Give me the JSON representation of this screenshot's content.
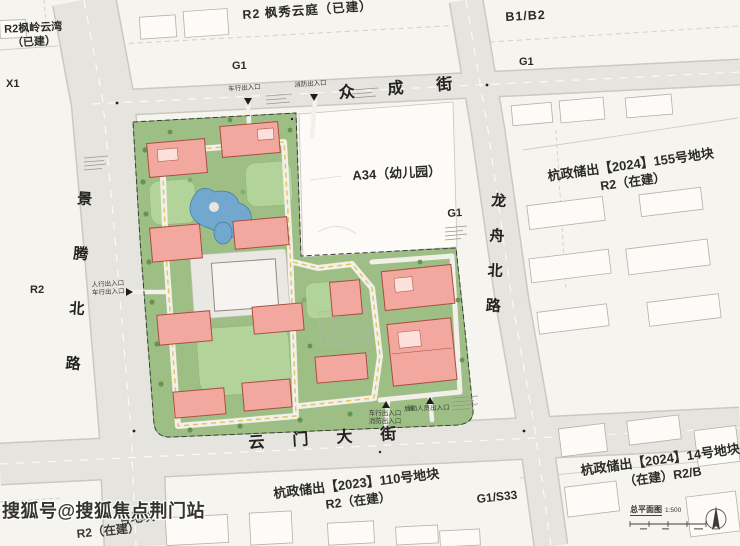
{
  "streets": {
    "top": "众成街",
    "bottom": "云门大街",
    "left": "景腾北路",
    "right": "龙舟北路"
  },
  "plots": {
    "northwest": {
      "name": "R2枫岭云湾",
      "status": "（已建）"
    },
    "x1": "X1",
    "north": "R2 枫秀云庭（已建）",
    "g1_north": "G1",
    "northeast": "B1/B2",
    "g1_northeast": "G1",
    "west": "R2",
    "kindergarten": "A34（幼儿园）",
    "g1_east": "G1",
    "east": {
      "line1": "杭政储出【2024】155号地块",
      "line2": "R2（在建）"
    },
    "south": {
      "line1": "杭政储出【2023】110号地块",
      "line2": "R2（在建）"
    },
    "g1_s33": "G1/S33",
    "southeast": {
      "line1": "杭政储出【2024】14号地块",
      "line2": "（在建）R2/B"
    },
    "southwest": {
      "line1_partial": "号地块",
      "line2": "R2（在建）"
    }
  },
  "entrances": {
    "north_vehicle": "车行出入口",
    "north_fire": "消防出入口",
    "west_line1": "人行出入口",
    "west_line2": "车行出入口",
    "south_line1": "车行出入口",
    "south_line2": "消防出入口",
    "south_service": "后勤人员出入口"
  },
  "legend": {
    "title": "总平面图",
    "scale": "1:500"
  },
  "watermark": "搜狐号@搜狐焦点荆门站",
  "colors": {
    "background": "#f6f4ef",
    "road_gray": "#e6e4de",
    "site_green": "#9dbf85",
    "lawn_green": "#b2d49a",
    "building_pink": "#f2a89f",
    "building_outline": "#ab4d42",
    "pond_blue": "#72a8ce"
  }
}
